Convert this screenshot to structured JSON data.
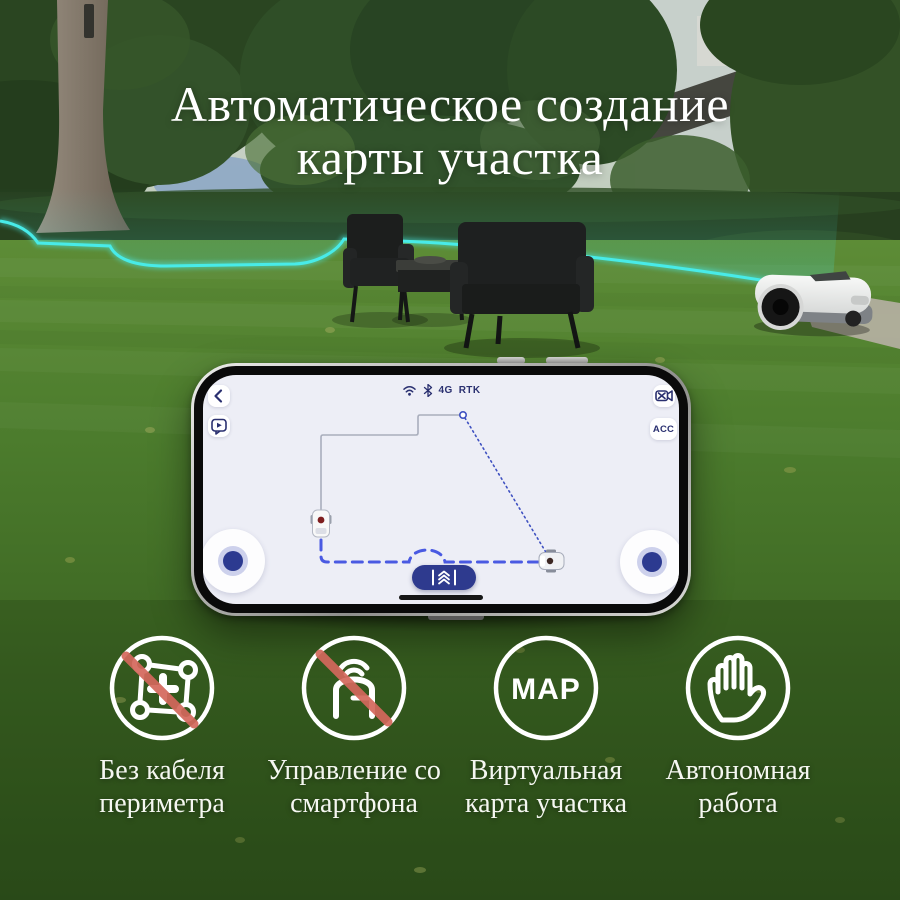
{
  "title": {
    "line1": "Автоматическое создание",
    "line2": "карты участка"
  },
  "phone": {
    "status_bar": {
      "icons": [
        "wifi-icon",
        "bluetooth-icon"
      ],
      "network": "4G",
      "positioning": "RTK"
    },
    "acc_button": "ACC",
    "map": {
      "boundary_color": "#a9aebc",
      "route_color": "#4a5ae2",
      "markers": [
        "mower-start-marker",
        "mower-current-marker"
      ]
    }
  },
  "features": [
    {
      "icon": "no-perimeter-wire-icon",
      "line1": "Без кабеля",
      "line2": "периметра"
    },
    {
      "icon": "no-base-station-icon",
      "line1": "Управление со",
      "line2": "смартфона"
    },
    {
      "icon": "map-badge-icon",
      "badge_text": "MAP",
      "line1": "Виртуальная",
      "line2": "карта участка"
    },
    {
      "icon": "hand-icon",
      "line1": "Автономная",
      "line2": "работа"
    }
  ],
  "colors": {
    "navy": "#2a3070",
    "screen_bg": "#edeef6",
    "route_blue": "#4a5ae2",
    "fence_cyan": "#48ebe8",
    "slash_red": "#d4685c"
  }
}
